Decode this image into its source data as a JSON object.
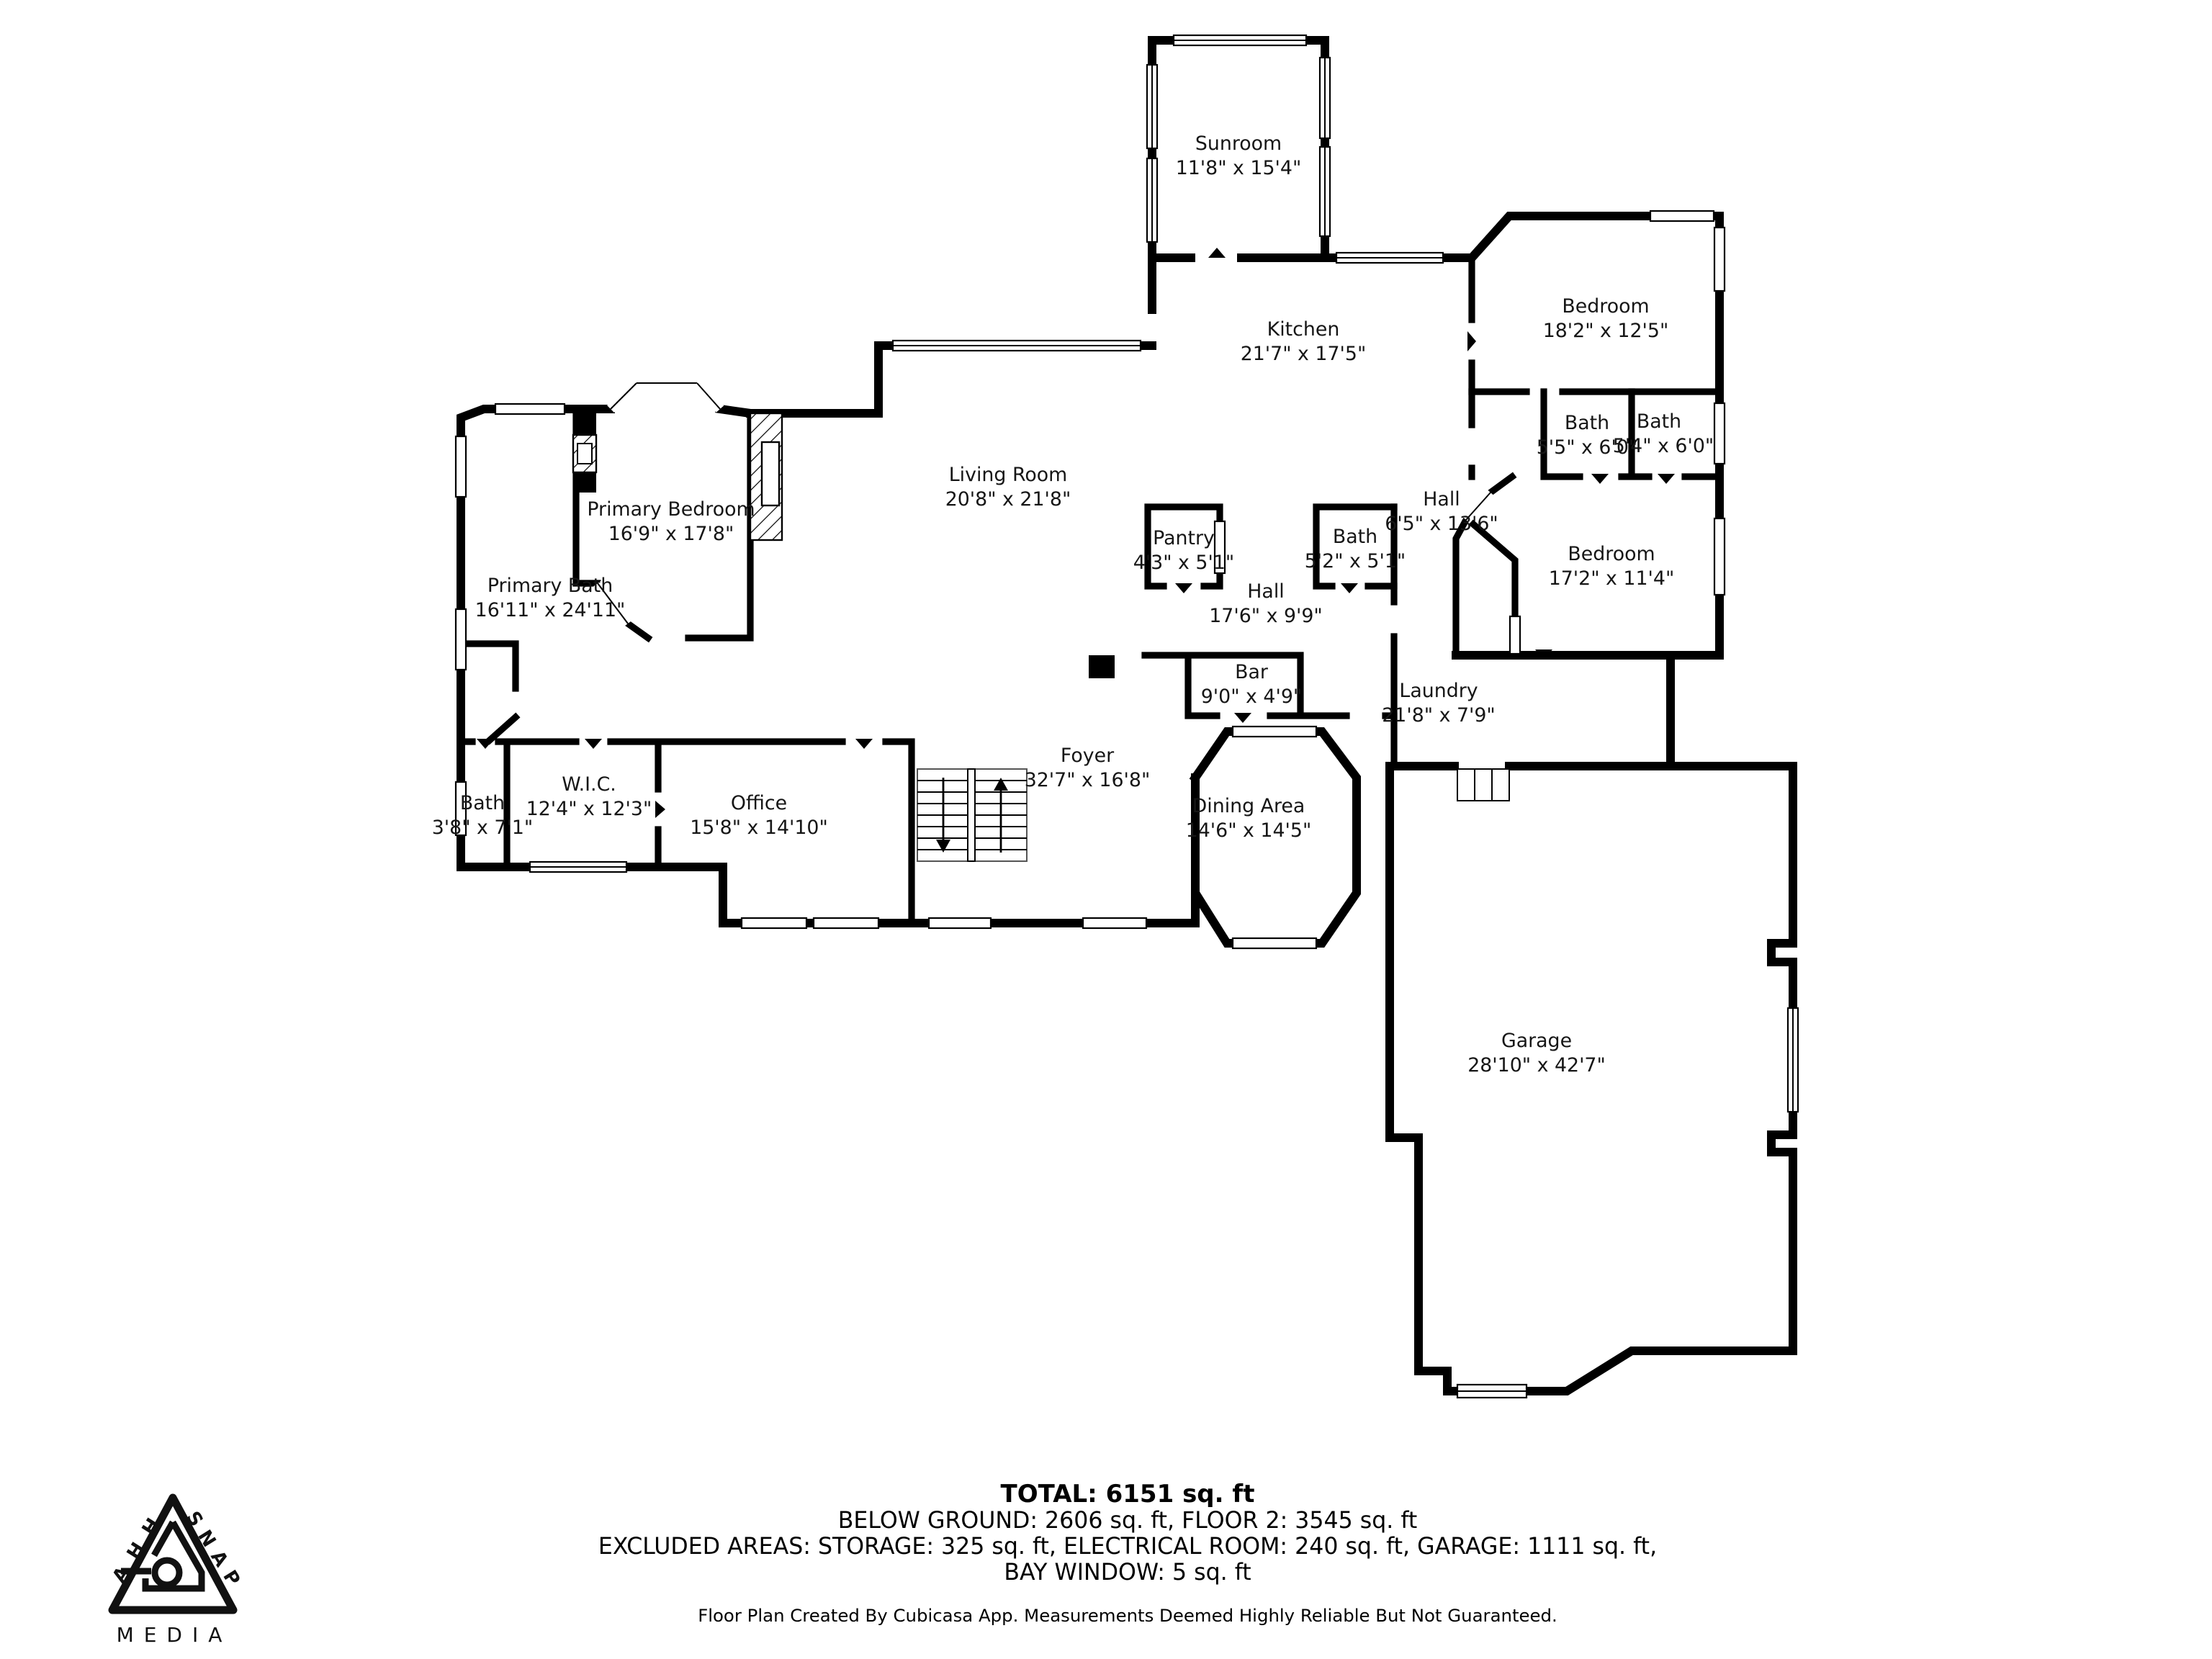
{
  "floor_plan": {
    "rooms": [
      {
        "name": "Sunroom",
        "dims": "11'8\" x 15'4\""
      },
      {
        "name": "Kitchen",
        "dims": "21'7\" x 17'5\""
      },
      {
        "name": "Bedroom",
        "dims": "18'2\" x 12'5\""
      },
      {
        "name": "Bath",
        "dims": "5'5\" x 6'0\""
      },
      {
        "name": "Bath",
        "dims": "5'4\" x 6'0\""
      },
      {
        "name": "Hall",
        "dims": "6'5\" x 13'6\""
      },
      {
        "name": "Bedroom",
        "dims": "17'2\" x 11'4\""
      },
      {
        "name": "Living Room",
        "dims": "20'8\" x 21'8\""
      },
      {
        "name": "Primary Bedroom",
        "dims": "16'9\" x 17'8\""
      },
      {
        "name": "Primary Bath",
        "dims": "16'11\" x 24'11\""
      },
      {
        "name": "Pantry",
        "dims": "4'3\" x 5'1\""
      },
      {
        "name": "Bath",
        "dims": "5'2\" x 5'1\""
      },
      {
        "name": "Hall",
        "dims": "17'6\" x 9'9\""
      },
      {
        "name": "Bar",
        "dims": "9'0\" x 4'9\""
      },
      {
        "name": "Laundry",
        "dims": "21'8\" x 7'9\""
      },
      {
        "name": "Foyer",
        "dims": "32'7\" x 16'8\""
      },
      {
        "name": "Dining Area",
        "dims": "14'6\" x 14'5\""
      },
      {
        "name": "W.I.C.",
        "dims": "12'4\" x 12'3\""
      },
      {
        "name": "Bath",
        "dims": "3'8\" x 7'1\""
      },
      {
        "name": "Office",
        "dims": "15'8\" x 14'10\""
      },
      {
        "name": "Garage",
        "dims": "28'10\" x 42'7\""
      }
    ],
    "summary": {
      "total": "TOTAL: 6151 sq. ft",
      "line2": "BELOW GROUND: 2606 sq. ft, FLOOR 2: 3545 sq. ft",
      "line3": "EXCLUDED AREAS: STORAGE: 325 sq. ft, ELECTRICAL ROOM: 240 sq. ft, GARAGE: 1111 sq. ft,",
      "line4": "BAY WINDOW: 5 sq. ft"
    },
    "footer": "Floor Plan Created By Cubicasa App. Measurements Deemed Highly Reliable But Not Guaranteed.",
    "logo": {
      "word1": "AHH",
      "word2": "SNAP",
      "word3": "MEDIA"
    },
    "colors": {
      "walls": "#000000",
      "background": "#ffffff",
      "text": "#161616"
    }
  }
}
